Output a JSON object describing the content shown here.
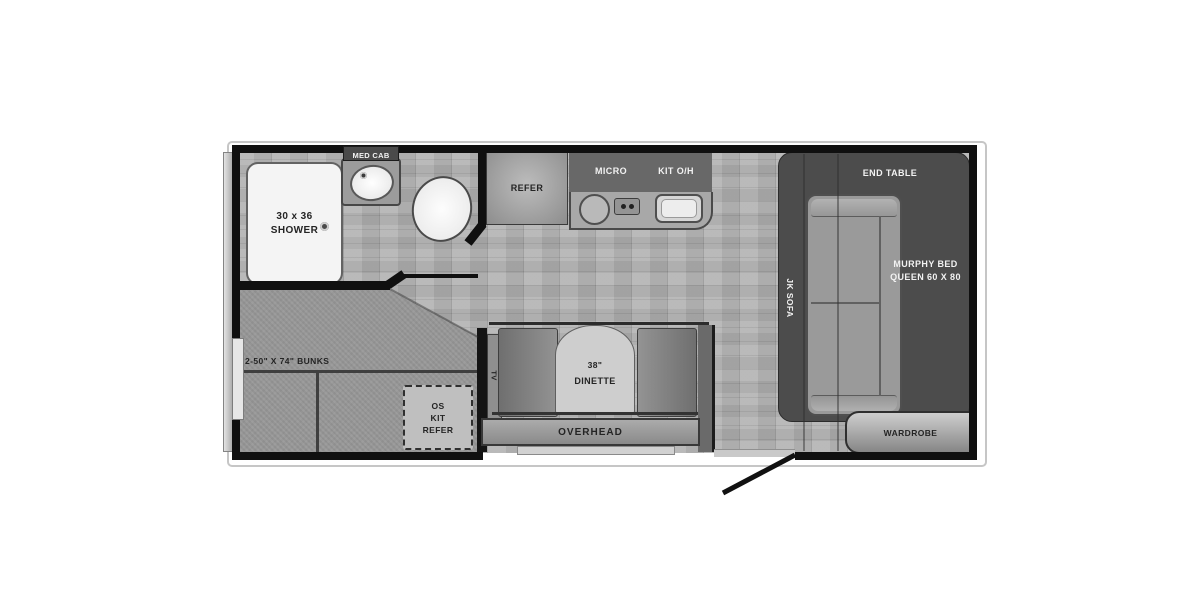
{
  "title": "Travel trailer floor plan",
  "colors": {
    "wall": "#101010",
    "floor": "#b2b2b2",
    "carpet": "#989898",
    "slide_panel": "#4c4c4c",
    "fixture_light": "#f4f4f4",
    "background": "#ffffff"
  },
  "bathroom": {
    "med_cab": "MED CAB",
    "shower_size": "30 x 36",
    "shower": "SHOWER"
  },
  "kitchen": {
    "refer": "REFER",
    "micro": "MICRO",
    "kit_overhead": "KIT O/H"
  },
  "living": {
    "end_table": "END TABLE",
    "sofa": "JK SOFA",
    "murphy_bed": "MURPHY BED",
    "murphy_size": "QUEEN 60 X 80",
    "wardrobe": "WARDROBE"
  },
  "bunk_room": {
    "bunks": "2-50\" X 74\" BUNKS",
    "outside_kitchen": [
      "OS",
      "KIT",
      "REFER"
    ]
  },
  "dinette": {
    "tv": "TV",
    "size": "38\"",
    "name": "DINETTE",
    "overhead": "OVERHEAD"
  }
}
